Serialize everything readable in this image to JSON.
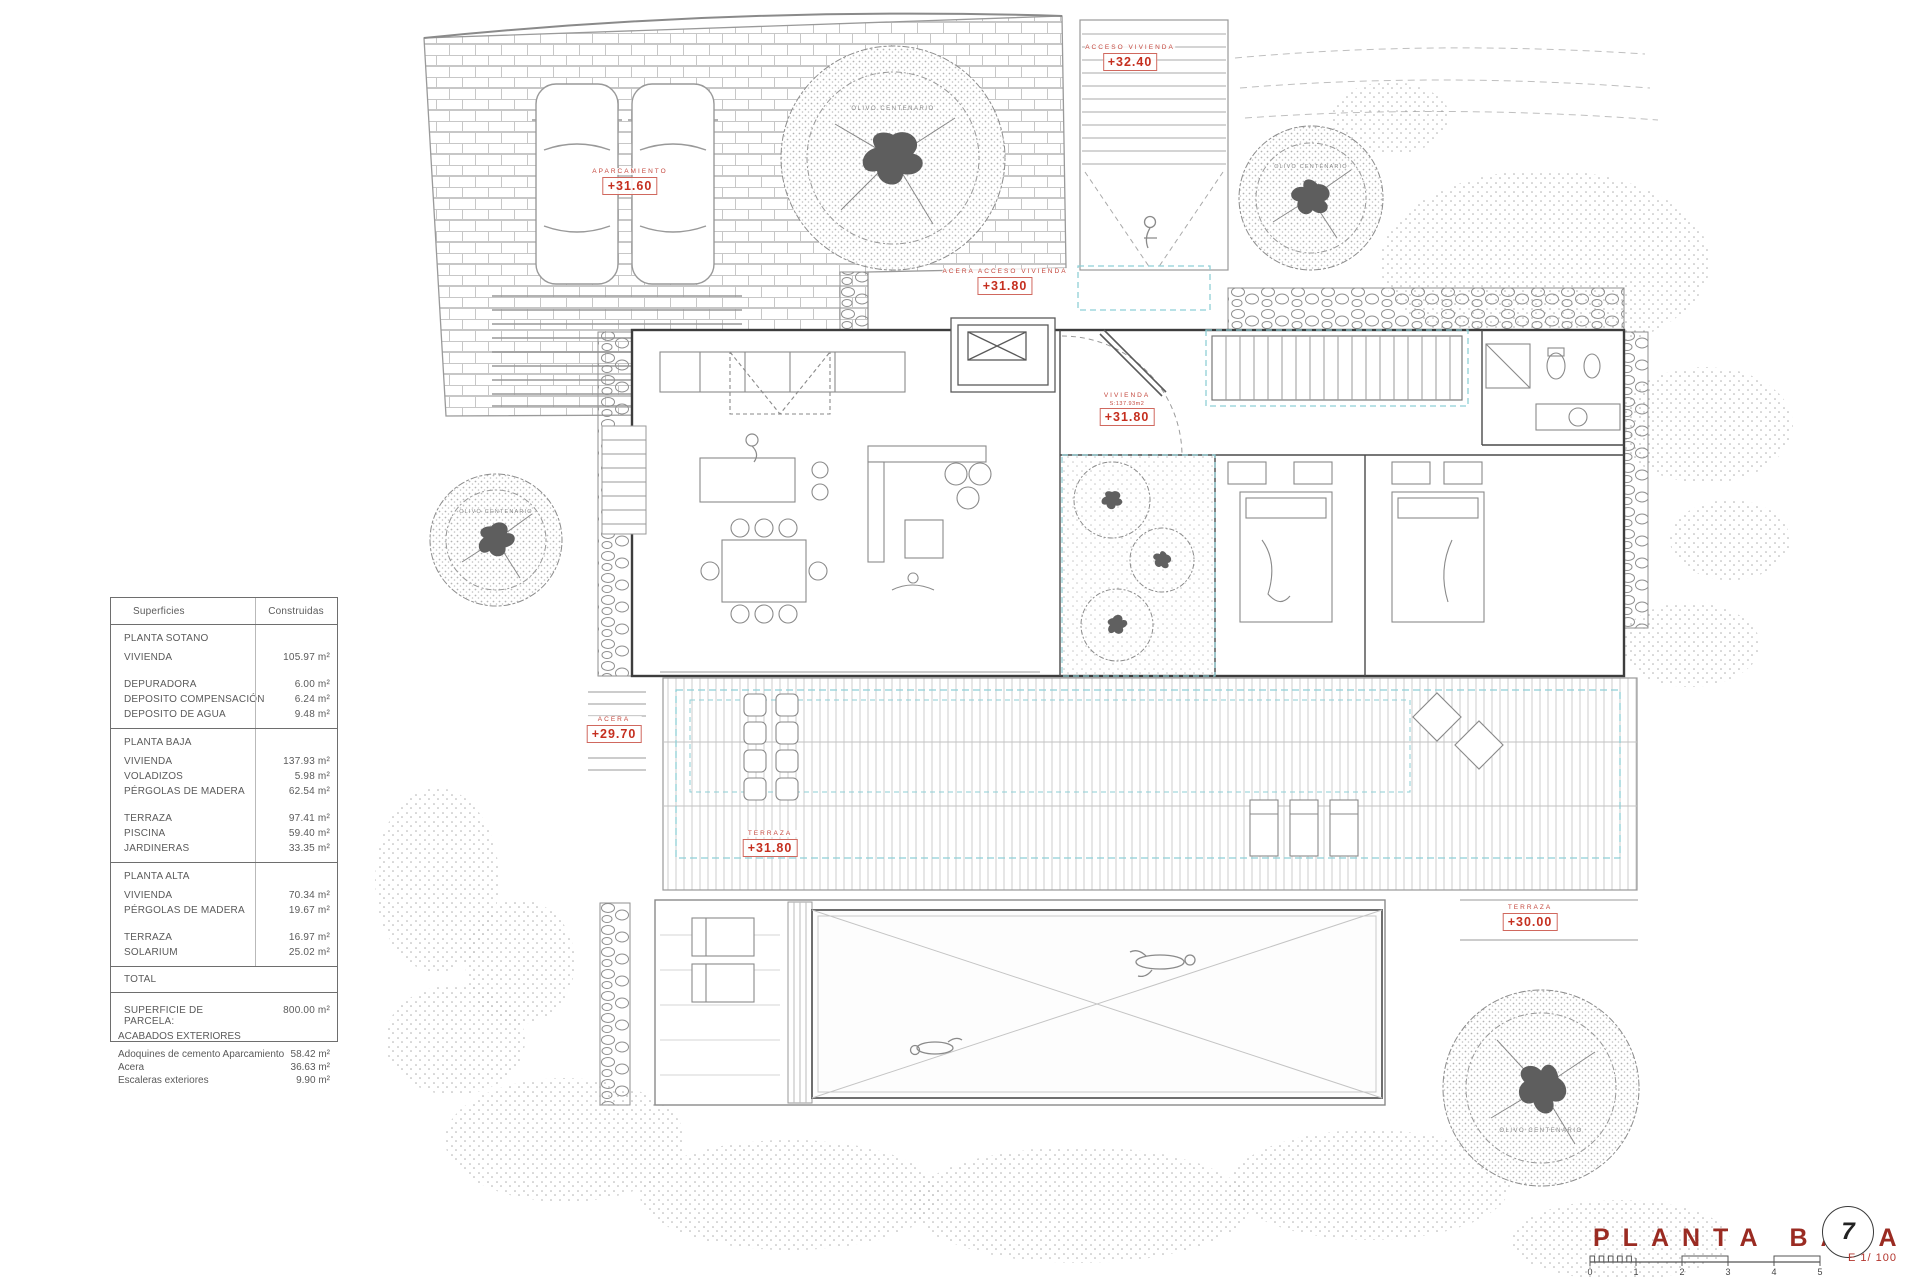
{
  "surfaces_table": {
    "headers": {
      "c1": "Superficies",
      "c2": "Construidas"
    },
    "s1": {
      "title": "PLANTA SOTANO",
      "rows": [
        {
          "l": "VIVIENDA",
          "v": "105.97 m²"
        },
        {
          "l": "DEPURADORA",
          "v": "6.00 m²"
        },
        {
          "l": "DEPOSITO COMPENSACIÓN",
          "v": "6.24 m²"
        },
        {
          "l": "DEPOSITO DE AGUA",
          "v": "9.48 m²"
        }
      ]
    },
    "s2": {
      "title": "PLANTA BAJA",
      "rows": [
        {
          "l": "VIVIENDA",
          "v": "137.93 m²"
        },
        {
          "l": "VOLADIZOS",
          "v": "5.98 m²"
        },
        {
          "l": "PÉRGOLAS DE MADERA",
          "v": "62.54 m²"
        },
        {
          "l": "TERRAZA",
          "v": "97.41 m²"
        },
        {
          "l": "PISCINA",
          "v": "59.40 m²"
        },
        {
          "l": "JARDINERAS",
          "v": "33.35 m²"
        }
      ]
    },
    "s3": {
      "title": "PLANTA ALTA",
      "rows": [
        {
          "l": "VIVIENDA",
          "v": "70.34 m²"
        },
        {
          "l": "PÉRGOLAS DE MADERA",
          "v": "19.67 m²"
        },
        {
          "l": "TERRAZA",
          "v": "16.97 m²"
        },
        {
          "l": "SOLARIUM",
          "v": "25.02 m²"
        }
      ]
    },
    "total_label": "TOTAL",
    "parcel_label": "SUPERFICIE DE PARCELA:",
    "parcel_value": "800.00 m²"
  },
  "exterior_finishes": {
    "title": "ACABADOS EXTERIORES",
    "rows": [
      {
        "l": "Adoquines de cemento Aparcamiento",
        "v": "58.42 m²"
      },
      {
        "l": "Acera",
        "v": "36.63 m²"
      },
      {
        "l": "Escaleras exteriores",
        "v": "9.90 m²"
      }
    ]
  },
  "plan_labels": {
    "aparcamiento": {
      "caption": "APARCAMIENTO",
      "elevation": "+31.60"
    },
    "acceso_vivienda": {
      "caption": "ACCESO VIVIENDA",
      "elevation": "+32.40"
    },
    "acera_acceso_vivienda": {
      "caption": "ACERA ACCESO VIVIENDA",
      "elevation": "+31.80"
    },
    "vivienda": {
      "caption": "VIVIENDA",
      "note": "S:137.93m2",
      "elevation": "+31.80"
    },
    "acera": {
      "caption": "ACERA",
      "elevation": "+29.70"
    },
    "terraza": {
      "caption": "TERRAZA",
      "elevation": "+31.80"
    },
    "terraza_este": {
      "caption": "TERRAZA",
      "elevation": "+30.00"
    },
    "olivo": "OLIVO CENTENARIO"
  },
  "title_block": {
    "title": "PLANTA BAJA",
    "sheet_number": "7",
    "scale_label": "E 1/ 100",
    "ticks": [
      "0",
      "1",
      "2",
      "3",
      "4",
      "5"
    ]
  },
  "colors": {
    "label_red": "#c52f1f",
    "title_red": "#9a2b22",
    "pergola_cyan": "#8ecfd6",
    "linework_gray": "#9a9a9a"
  }
}
